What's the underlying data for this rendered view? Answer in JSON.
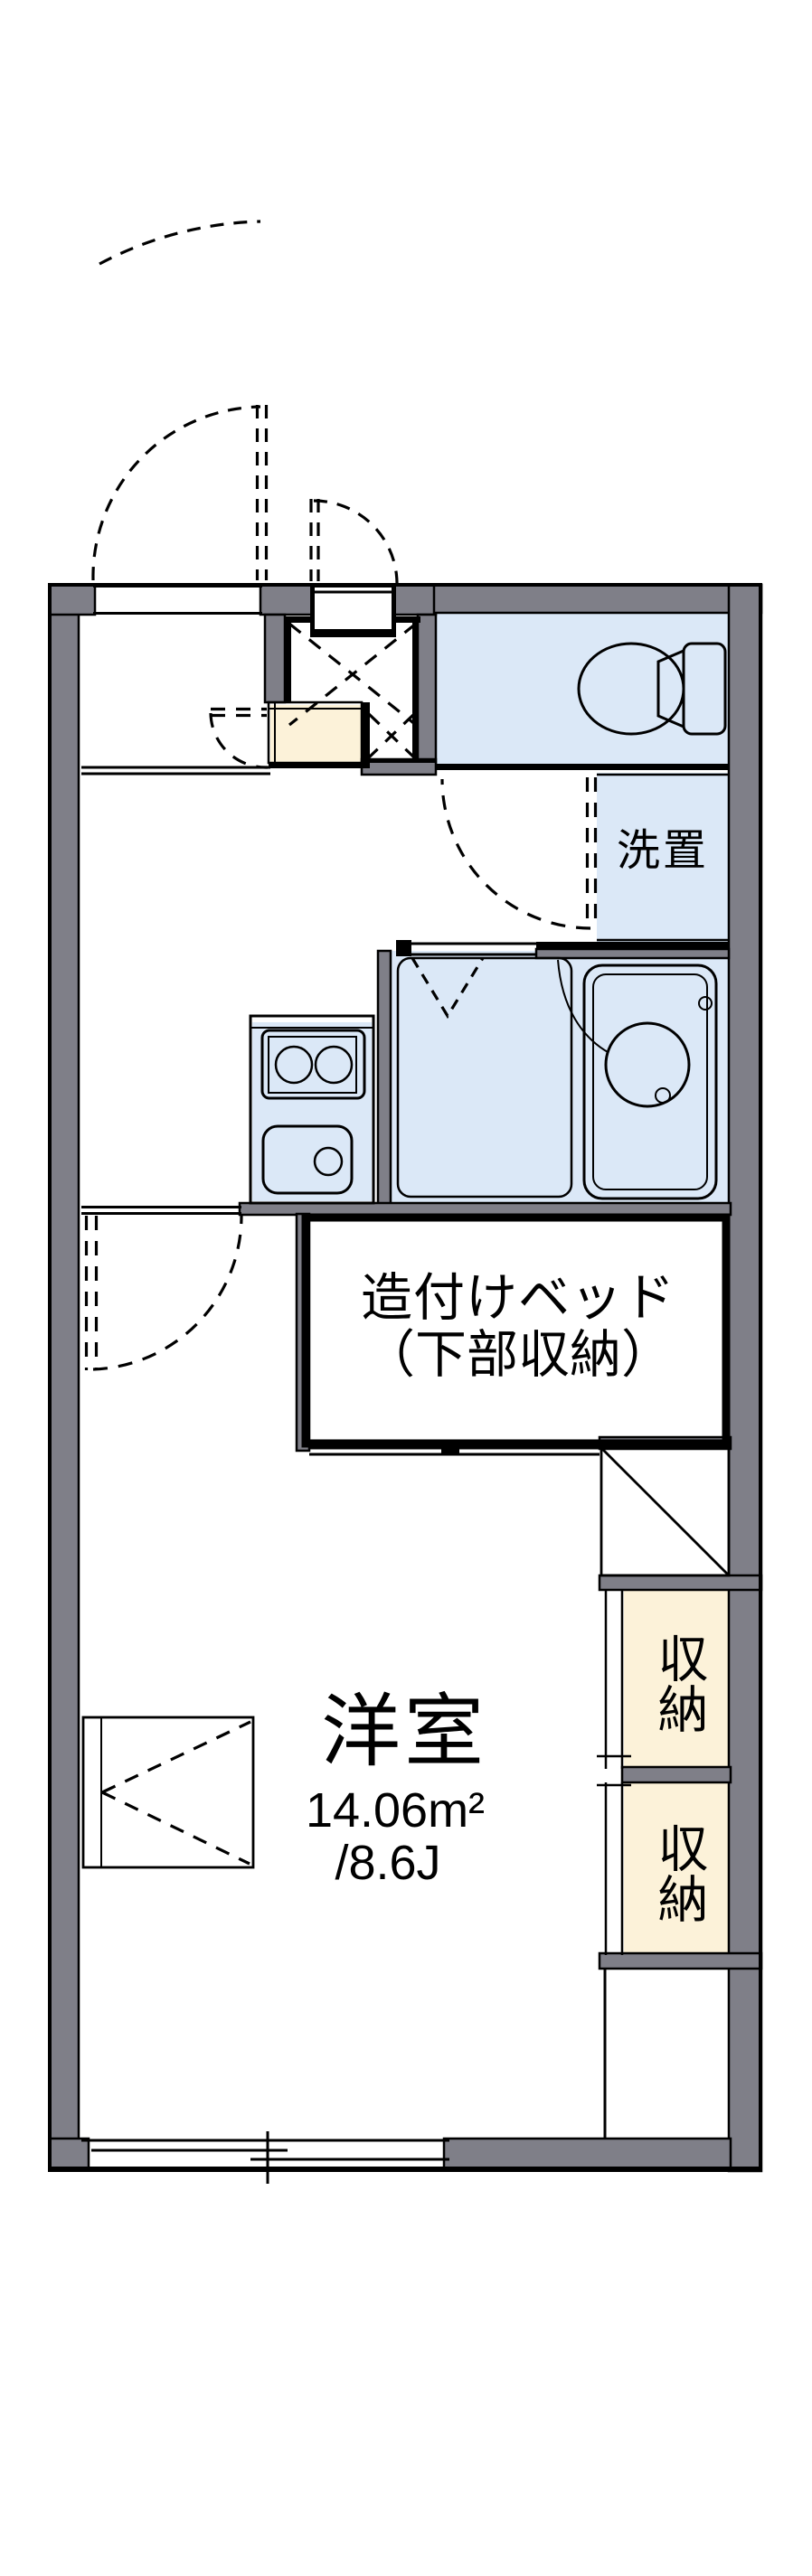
{
  "floorplan": {
    "title": "1K apartment floor plan",
    "labels": {
      "washer_space": "洗置",
      "bed_line1": "造付けベッド",
      "bed_line2": "（下部収納）",
      "closet_upper": "収納",
      "closet_lower": "収納",
      "room_name": "洋室",
      "room_area_m2": "14.06m²",
      "room_area_jo": "/8.6J"
    },
    "icons": {
      "toilet": "toilet-icon",
      "bathtub": "bathtub-icon",
      "wash_basin": "wash-basin-icon",
      "stove": "stove-burners-icon",
      "kitchen_sink": "kitchen-sink-icon",
      "doors": "door-swing-arc-icon",
      "window": "sliding-window-icon"
    },
    "colors": {
      "wall": "#7f7f88",
      "water": "#dbe8f7",
      "storage": "#fcf2d9",
      "line": "#000000",
      "bg": "#ffffff"
    }
  }
}
